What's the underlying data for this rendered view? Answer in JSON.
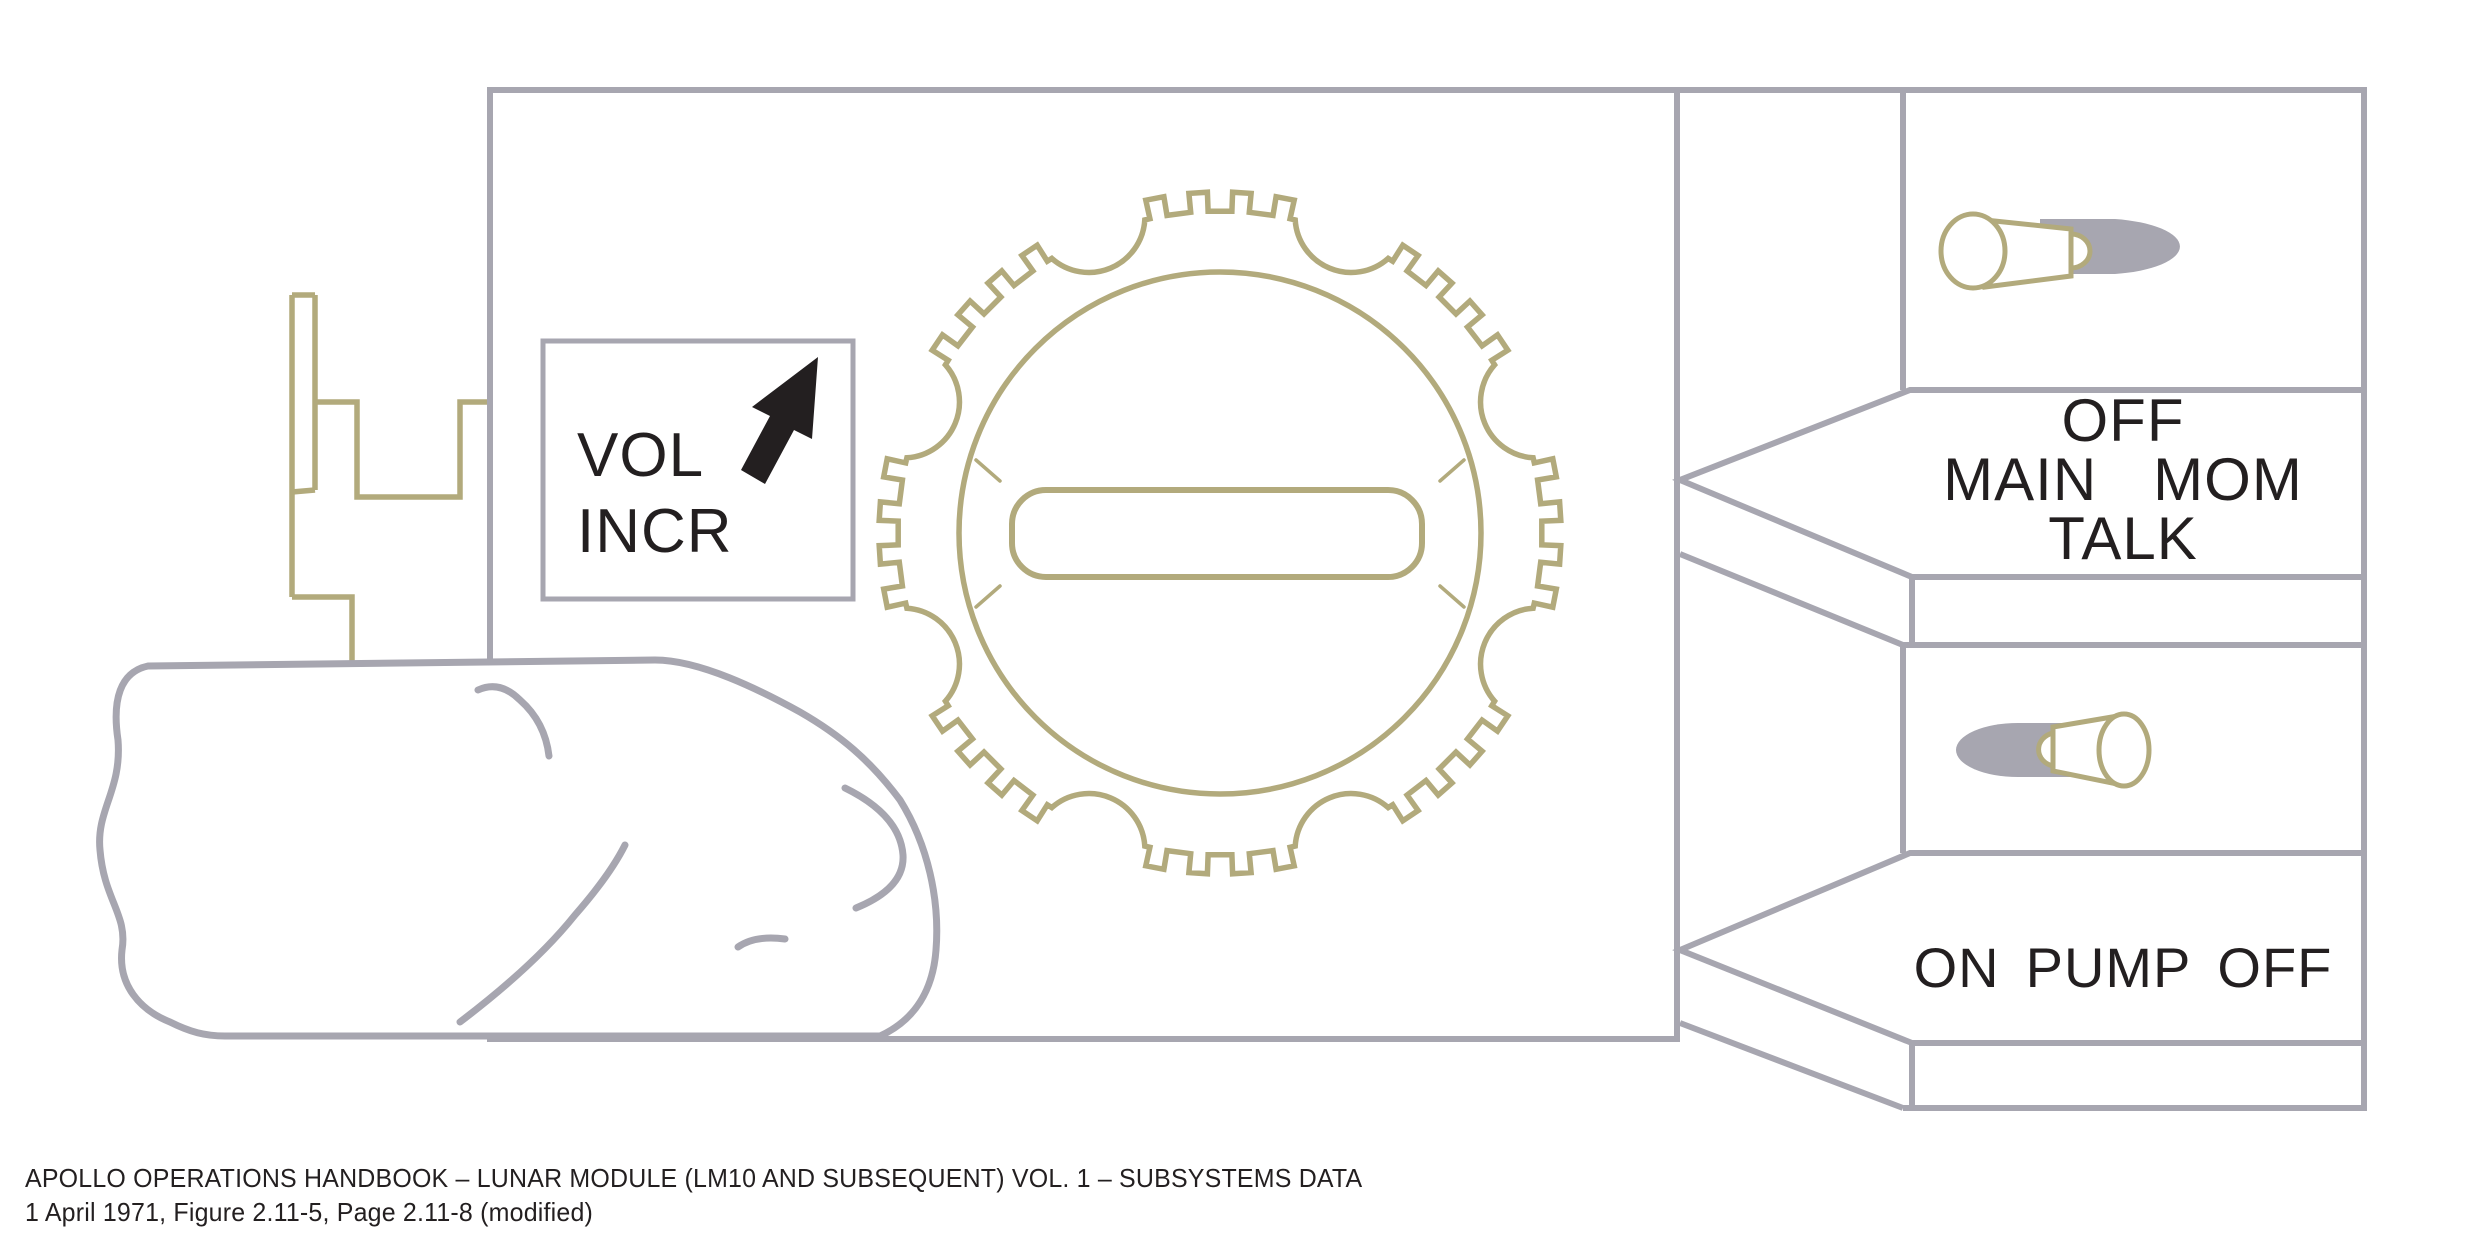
{
  "diagram": {
    "caption": {
      "line1": "APOLLO OPERATIONS HANDBOOK – LUNAR MODULE (LM10 AND SUBSEQUENT) VOL. 1 – SUBSYSTEMS DATA",
      "line2": "1 April 1971, Figure 2.11-5, Page 2.11-8 (modified)"
    },
    "volume_control": {
      "label_line1": "VOL",
      "label_line2": "INCR",
      "arrow_direction": "up-right"
    },
    "talk_switch": {
      "top": "OFF",
      "left": "MAIN",
      "right": "MOM",
      "bottom": "TALK"
    },
    "pump_switch": {
      "left": "ON",
      "center": "PUMP",
      "right": "OFF"
    },
    "icons": {
      "thumbwheel": "knurled-thumbwheel-icon",
      "volume_arrow": "arrow-up-right-icon",
      "hand": "thumb-hand-icon",
      "talk_toggle": "toggle-lever-icon",
      "pump_toggle": "toggle-lever-icon"
    },
    "colors": {
      "line_gray": "#a7a6b0",
      "olive": "#b2aa7c",
      "ink": "#231f20"
    }
  }
}
